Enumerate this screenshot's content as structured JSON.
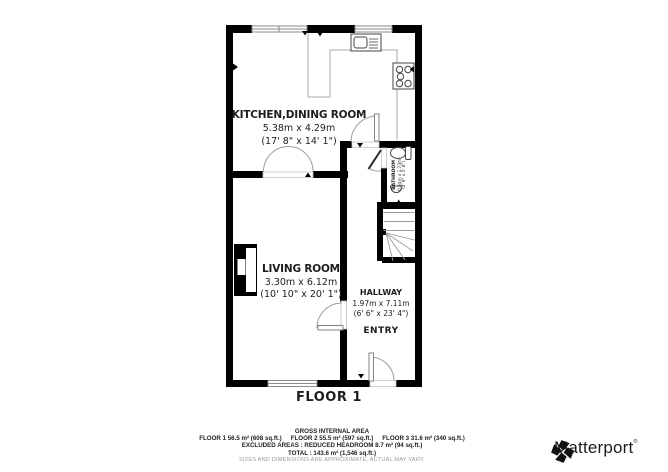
{
  "plan": {
    "floor_label": "FLOOR 1",
    "rooms": {
      "kitchen": {
        "name": "KITCHEN,DINING ROOM",
        "metric": "5.38m x 4.29m",
        "imperial": "(17' 8\" x 14' 1\")"
      },
      "living": {
        "name": "LIVING ROOM",
        "metric": "3.30m x 6.12m",
        "imperial": "(10' 10\" x 20' 1\")"
      },
      "hallway": {
        "name": "HALLWAY",
        "metric": "1.97m x 7.11m",
        "imperial": "(6' 6\" x 23' 4\")"
      },
      "entry": {
        "name": "ENTRY"
      },
      "bathroom": {
        "name": "BATHROOM",
        "metric": "0.84m x 1.73m",
        "imperial": "(2' 9\" x 5' 8\")"
      }
    }
  },
  "footer": {
    "title": "GROSS INTERNAL AREA",
    "floor1": "FLOOR 1 56.5 m² (608 sq.ft.)",
    "floor2": "FLOOR 2 55.5 m² (597 sq.ft.)",
    "floor3": "FLOOR 3 31.6 m² (340 sq.ft.)",
    "excluded": "EXCLUDED AREAS :  REDUCED HEADROOM 8.7 m² (94 sq.ft.)",
    "total": "TOTAL :  143.6 m² (1,546 sq.ft.)",
    "disclaimer": "SIZES AND DIMENSIONS ARE APPROXIMATE, ACTUAL MAY VARY."
  },
  "branding": {
    "name": "Matterport",
    "trademark": "®"
  },
  "colors": {
    "wall": "#000000",
    "thin_line": "#9b9b9b",
    "text": "#1d1d1d",
    "disclaimer_text": "#9a9a9a"
  }
}
